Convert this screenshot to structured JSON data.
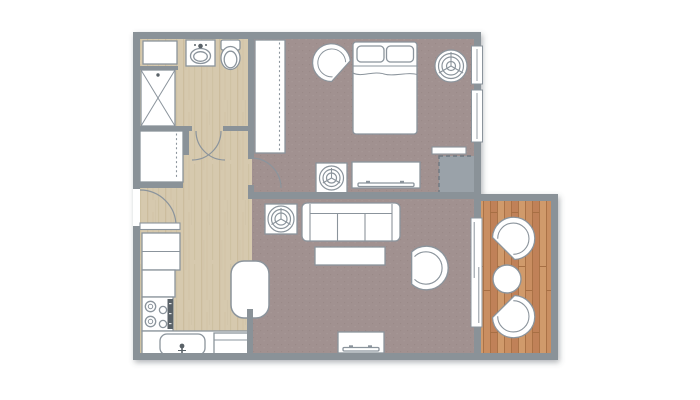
{
  "document": {
    "kind": "apartment-floor-plan",
    "visible_text": []
  },
  "palette": {
    "background": "#ffffff",
    "wall": "#8a9298",
    "outline": "#8b949c",
    "furniture_fill": "#ffffff",
    "fixture_dark": "#5a6268",
    "wood": "#d6c9ae",
    "wood_grain": "#c2b392",
    "wood_grain2": "#cdbfa2",
    "carpet": "#a19190",
    "carpet_dot": "#91817f",
    "carpet_light": "#b0a19e",
    "deck": "#c98e61",
    "deck_alt": "#c08158",
    "deck_alt2": "#d09a6b",
    "deck_line": "#a76f44",
    "closet_dash_fill": "#9aa2a9",
    "closet_dash_stroke": "#6e7880"
  },
  "rooms": [
    {
      "name": "bathroom",
      "floor": "wood"
    },
    {
      "name": "hallway",
      "floor": "wood"
    },
    {
      "name": "kitchen",
      "floor": "wood"
    },
    {
      "name": "bedroom",
      "floor": "carpet"
    },
    {
      "name": "living-room",
      "floor": "carpet"
    },
    {
      "name": "balcony",
      "floor": "deck"
    }
  ],
  "plan": {
    "canvas": {
      "w": 700,
      "h": 400
    },
    "footprint": "M133,32 L481,32 L481,194 L558,194 L558,360 L133,360 Z",
    "floors": [
      {
        "name": "floor-hall-kitchen-bathroom",
        "pattern": "wood",
        "x": 140,
        "y": 38,
        "w": 112,
        "h": 316
      },
      {
        "name": "floor-bedroom",
        "pattern": "carpet",
        "x": 252,
        "y": 38,
        "w": 222,
        "h": 156
      },
      {
        "name": "floor-living-room",
        "pattern": "carpet",
        "x": 252,
        "y": 194,
        "w": 222,
        "h": 160
      },
      {
        "name": "floor-balcony",
        "pattern": "deck",
        "x": 481,
        "y": 201,
        "w": 70,
        "h": 152
      }
    ],
    "walls": [
      [
        133,
        32,
        348,
        7
      ],
      [
        133,
        32,
        7,
        157
      ],
      [
        133,
        226,
        7,
        134
      ],
      [
        133,
        353,
        425,
        7
      ],
      [
        474,
        32,
        7,
        321
      ],
      [
        481,
        194,
        77,
        7
      ],
      [
        551,
        194,
        7,
        166
      ],
      [
        248,
        192,
        226,
        7
      ],
      [
        248,
        32,
        6,
        127
      ],
      [
        248,
        185,
        6,
        7
      ],
      [
        247,
        309,
        6,
        44
      ],
      [
        133,
        126,
        59,
        5
      ],
      [
        223,
        126,
        31,
        5
      ],
      [
        183,
        126,
        6,
        29
      ],
      [
        133,
        182,
        50,
        6
      ],
      [
        140,
        66,
        38,
        4
      ]
    ],
    "windows": [
      {
        "name": "bedroom-window-1",
        "x": 471.5,
        "y": 46,
        "w": 11,
        "h": 38
      },
      {
        "name": "bedroom-window-2",
        "x": 471.5,
        "y": 90,
        "w": 11,
        "h": 52
      },
      {
        "name": "balcony-sliding-door",
        "x": 471,
        "y": 218,
        "w": 11,
        "h": 109,
        "panels": true
      }
    ],
    "doors": [
      {
        "name": "entry-door",
        "arc": "M140,190 A36,36 0 0 1 176,226",
        "leaf": [
          140,
          223,
          40,
          6.5
        ]
      },
      {
        "name": "bathroom-door-swing-left",
        "arc": "M221,131 A29,29 0 0 1 192,160"
      },
      {
        "name": "bathroom-door-swing-right",
        "arc": "M225,160 A29,29 0 0 1 196,131"
      },
      {
        "name": "bedroom-door",
        "arc": "M251,158 A30,30 0 0 1 281,188"
      },
      {
        "name": "utility-closet-door",
        "leaf": [
          432,
          147,
          34,
          7
        ]
      }
    ],
    "fixtures": [
      {
        "name": "bathroom-cabinet",
        "parts": [
          {
            "k": "r",
            "x": 143,
            "y": 41,
            "w": 34,
            "h": 23
          }
        ]
      },
      {
        "name": "bathroom-sink-vanity",
        "parts": [
          {
            "k": "r",
            "x": 186,
            "y": 40,
            "w": 29,
            "h": 26
          },
          {
            "k": "e",
            "cx": 200.5,
            "cy": 56,
            "rx": 10,
            "ry": 7.5
          },
          {
            "k": "e",
            "cx": 200.5,
            "cy": 56.5,
            "rx": 6.8,
            "ry": 4.8
          },
          {
            "k": "c",
            "cx": 200.5,
            "cy": 46,
            "r": 2.3,
            "f": "#5a6268",
            "s": "none"
          },
          {
            "k": "c",
            "cx": 195,
            "cy": 45,
            "r": 1,
            "f": "#5a6268",
            "s": "none"
          },
          {
            "k": "c",
            "cx": 206,
            "cy": 45,
            "r": 1,
            "f": "#5a6268",
            "s": "none"
          }
        ]
      },
      {
        "name": "toilet",
        "parts": [
          {
            "k": "r",
            "x": 221,
            "y": 40,
            "w": 19,
            "h": 10,
            "rx": 2
          },
          {
            "k": "e",
            "cx": 230.5,
            "cy": 58,
            "rx": 9.5,
            "ry": 11.5
          },
          {
            "k": "e",
            "cx": 230.5,
            "cy": 59.5,
            "rx": 6.3,
            "ry": 8.3
          }
        ]
      },
      {
        "name": "shower",
        "parts": [
          {
            "k": "r",
            "x": 141,
            "y": 70,
            "w": 34,
            "h": 56
          },
          {
            "k": "l",
            "x1": 141,
            "y1": 70,
            "x2": 175,
            "y2": 126,
            "sw": 1
          },
          {
            "k": "l",
            "x1": 175,
            "y1": 70,
            "x2": 141,
            "y2": 126,
            "sw": 1
          },
          {
            "k": "c",
            "cx": 158,
            "cy": 75,
            "r": 1.7,
            "f": "#5a6268",
            "s": "none"
          }
        ]
      },
      {
        "name": "hallway-closet",
        "parts": [
          {
            "k": "r",
            "x": 140,
            "y": 131,
            "w": 43,
            "h": 51
          },
          {
            "k": "l",
            "x1": 176.5,
            "y1": 133.5,
            "x2": 176.5,
            "y2": 179.5,
            "da": "2,2.6",
            "sw": 1.1
          }
        ]
      },
      {
        "name": "fridge",
        "parts": [
          {
            "k": "r",
            "x": 142,
            "y": 233,
            "w": 38,
            "h": 37
          },
          {
            "k": "l",
            "x1": 142,
            "y1": 251.5,
            "x2": 180,
            "y2": 251.5,
            "sw": 1
          }
        ]
      },
      {
        "name": "kitchen-counter",
        "parts": [
          {
            "k": "r",
            "x": 142,
            "y": 270,
            "w": 33,
            "h": 27
          }
        ]
      },
      {
        "name": "stove",
        "parts": [
          {
            "k": "r",
            "x": 142,
            "y": 297,
            "w": 31,
            "h": 34
          },
          {
            "k": "c",
            "cx": 150.5,
            "cy": 306.5,
            "r": 5.2,
            "f": "none"
          },
          {
            "k": "c",
            "cx": 150.5,
            "cy": 306.5,
            "r": 2.2,
            "f": "none",
            "sw": 1
          },
          {
            "k": "c",
            "cx": 150.5,
            "cy": 321.5,
            "r": 5.2,
            "f": "none"
          },
          {
            "k": "c",
            "cx": 150.5,
            "cy": 321.5,
            "r": 2.2,
            "f": "none",
            "sw": 1
          },
          {
            "k": "c",
            "cx": 163,
            "cy": 310,
            "r": 3.6,
            "f": "none"
          },
          {
            "k": "c",
            "cx": 163,
            "cy": 324,
            "r": 3.6,
            "f": "none"
          },
          {
            "k": "r",
            "x": 167.5,
            "y": 299,
            "w": 5.5,
            "h": 30,
            "f": "#5a6268",
            "s": "none"
          },
          {
            "k": "r",
            "x": 169,
            "y": 303,
            "w": 2.5,
            "h": 1.2,
            "f": "#e6e6e6",
            "s": "none"
          },
          {
            "k": "r",
            "x": 169,
            "y": 313,
            "w": 2.5,
            "h": 1.2,
            "f": "#e6e6e6",
            "s": "none"
          },
          {
            "k": "r",
            "x": 169,
            "y": 323,
            "w": 2.5,
            "h": 1.2,
            "f": "#e6e6e6",
            "s": "none"
          }
        ]
      },
      {
        "name": "kitchen-sink-counter",
        "parts": [
          {
            "k": "r",
            "x": 142,
            "y": 331,
            "w": 106,
            "h": 25
          }
        ]
      },
      {
        "name": "kitchen-sink",
        "parts": [
          {
            "k": "r",
            "x": 160,
            "y": 334,
            "w": 45,
            "h": 21,
            "rx": 7
          },
          {
            "k": "c",
            "cx": 182,
            "cy": 346,
            "r": 2.4,
            "f": "#5a6268",
            "s": "none"
          },
          {
            "k": "l",
            "x1": 182,
            "y1": 348,
            "x2": 182,
            "y2": 356.5,
            "s": "#5a6268",
            "sw": 1.6
          },
          {
            "k": "l",
            "x1": 178,
            "y1": 350.5,
            "x2": 186,
            "y2": 350.5,
            "s": "#5a6268",
            "sw": 1
          }
        ]
      },
      {
        "name": "dishwasher",
        "parts": [
          {
            "k": "r",
            "x": 214,
            "y": 333,
            "w": 34,
            "h": 21
          },
          {
            "k": "l",
            "x1": 214,
            "y1": 340,
            "x2": 248,
            "y2": 340,
            "sw": 1
          }
        ]
      },
      {
        "name": "dining-table",
        "parts": [
          {
            "k": "r",
            "x": 231,
            "y": 261,
            "w": 38,
            "h": 57,
            "rx": 13,
            "sw": 1.5
          }
        ]
      },
      {
        "name": "living-room-plant",
        "parts": [
          {
            "k": "plant",
            "cx": 281,
            "cy": 219,
            "rr": [
              13,
              9.5,
              6
            ],
            "pot": [
              265,
              204,
              32,
              30
            ]
          }
        ]
      },
      {
        "name": "sofa",
        "parts": [
          {
            "k": "r",
            "x": 302,
            "y": 203,
            "w": 98,
            "h": 38,
            "rx": 5
          },
          {
            "k": "l",
            "x1": 310,
            "y1": 213.5,
            "x2": 392,
            "y2": 213.5,
            "sw": 1.1
          },
          {
            "k": "l",
            "x1": 310,
            "y1": 204,
            "x2": 310,
            "y2": 240.5,
            "sw": 1.1
          },
          {
            "k": "l",
            "x1": 392,
            "y1": 204,
            "x2": 392,
            "y2": 240.5,
            "sw": 1.1
          },
          {
            "k": "l",
            "x1": 337.5,
            "y1": 213.5,
            "x2": 337.5,
            "y2": 240.5,
            "sw": 1.1
          },
          {
            "k": "l",
            "x1": 365,
            "y1": 213.5,
            "x2": 365,
            "y2": 240.5,
            "sw": 1.1
          }
        ]
      },
      {
        "name": "coffee-table",
        "parts": [
          {
            "k": "r",
            "x": 315,
            "y": 247,
            "w": 70,
            "h": 18
          }
        ]
      },
      {
        "name": "armchair",
        "parts": [
          {
            "k": "chair",
            "x": 424,
            "y": 268,
            "rot": 180,
            "sc": 0.95
          }
        ]
      },
      {
        "name": "living-room-tv-console",
        "parts": [
          {
            "k": "r",
            "x": 338,
            "y": 332,
            "w": 46,
            "h": 21
          },
          {
            "k": "r",
            "x": 343,
            "y": 347.5,
            "w": 36,
            "h": 3.5,
            "rx": 1.2
          },
          {
            "k": "r",
            "x": 349,
            "y": 345.3,
            "w": 4,
            "h": 2,
            "f": "#8b949c",
            "s": "none"
          },
          {
            "k": "r",
            "x": 368,
            "y": 345.3,
            "w": 4,
            "h": 2,
            "f": "#8b949c",
            "s": "none"
          }
        ]
      },
      {
        "name": "bedroom-wardrobe",
        "parts": [
          {
            "k": "r",
            "x": 255,
            "y": 40,
            "w": 30,
            "h": 113
          },
          {
            "k": "l",
            "x1": 279.5,
            "y1": 42.5,
            "x2": 279.5,
            "y2": 150.5,
            "da": "2,2.6",
            "sw": 1.1
          }
        ]
      },
      {
        "name": "bed",
        "parts": [
          {
            "k": "r",
            "x": 353,
            "y": 42,
            "w": 64,
            "h": 92,
            "rx": 3
          },
          {
            "k": "r",
            "x": 357,
            "y": 46,
            "w": 27,
            "h": 16,
            "rx": 4
          },
          {
            "k": "r",
            "x": 386.5,
            "y": 46,
            "w": 27,
            "h": 16,
            "rx": 4
          },
          {
            "k": "l",
            "x1": 353,
            "y1": 66,
            "x2": 417,
            "y2": 66,
            "sw": 1
          },
          {
            "k": "p",
            "d": "M353,73 C362,77.5 373,70.5 384,74 C394,77 408,71.5 417,74.5",
            "sw": 1
          }
        ]
      },
      {
        "name": "bedroom-chair",
        "parts": [
          {
            "k": "chair",
            "x": 333,
            "y": 64,
            "rot": 42,
            "sc": 0.82
          }
        ]
      },
      {
        "name": "bedroom-plant-large",
        "parts": [
          {
            "k": "plant",
            "cx": 451,
            "cy": 66,
            "rr": [
              16,
              12.5,
              9,
              4.5
            ]
          }
        ]
      },
      {
        "name": "bedroom-plant-small",
        "parts": [
          {
            "k": "plant",
            "cx": 331.5,
            "cy": 178,
            "rr": [
              12,
              8.5,
              5
            ],
            "pot": [
              316,
              163,
              31,
              30
            ]
          }
        ]
      },
      {
        "name": "bedroom-dresser-tv",
        "parts": [
          {
            "k": "r",
            "x": 352,
            "y": 162,
            "w": 68,
            "h": 26
          },
          {
            "k": "r",
            "x": 358,
            "y": 183,
            "w": 56,
            "h": 3.5,
            "rx": 1.2
          },
          {
            "k": "r",
            "x": 366,
            "y": 180.8,
            "w": 4,
            "h": 2,
            "f": "#8b949c",
            "s": "none"
          },
          {
            "k": "r",
            "x": 400,
            "y": 180.8,
            "w": 4,
            "h": 2,
            "f": "#8b949c",
            "s": "none"
          }
        ]
      },
      {
        "name": "utility-closet",
        "parts": [
          {
            "k": "r",
            "x": 439,
            "y": 156,
            "w": 38,
            "h": 37,
            "f": "#9aa2a9",
            "s": "#6e7880",
            "da": "4,3",
            "sw": 1.4
          }
        ]
      },
      {
        "name": "balcony-chair-top",
        "parts": [
          {
            "k": "chair",
            "x": 512,
            "y": 240,
            "rot": 135,
            "sc": 0.92
          }
        ]
      },
      {
        "name": "balcony-chair-bottom",
        "parts": [
          {
            "k": "chair",
            "x": 512,
            "y": 315,
            "rot": 225,
            "sc": 0.92
          }
        ]
      },
      {
        "name": "balcony-table",
        "parts": [
          {
            "k": "c",
            "cx": 507,
            "cy": 279,
            "r": 14,
            "sw": 1.4
          }
        ]
      }
    ]
  }
}
